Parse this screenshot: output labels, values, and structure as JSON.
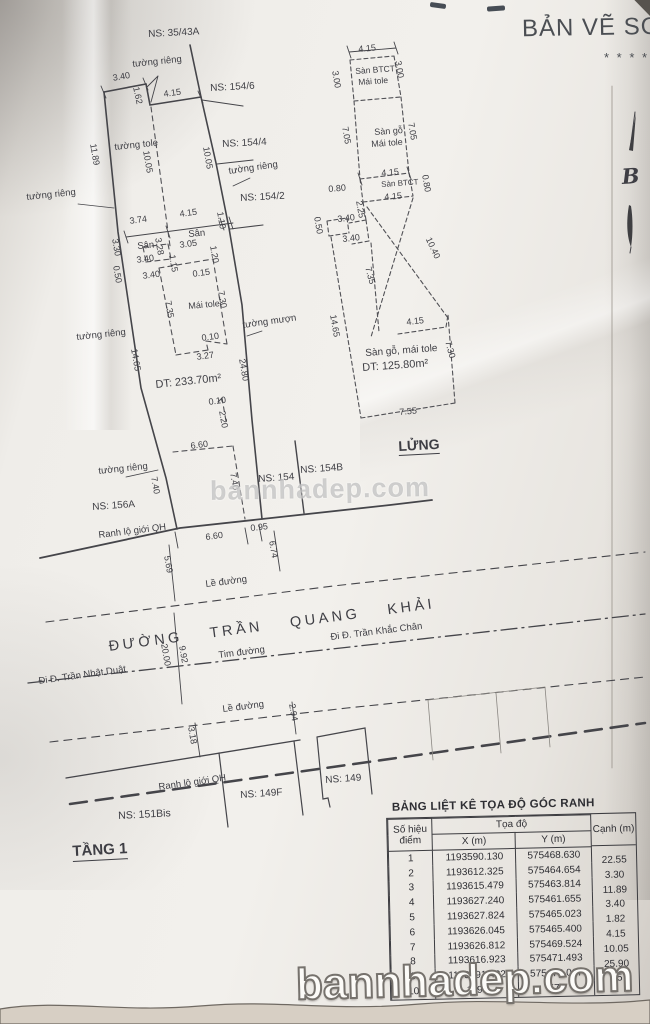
{
  "title": {
    "text": "BẢN VẼ SƠ",
    "stars": "* * * * *"
  },
  "watermark": {
    "middle": "bannhadep.com",
    "bottom": "bannhadep.com"
  },
  "table": {
    "title": "BẢNG LIỆT KÊ TỌA ĐỘ GÓC RANH",
    "headers": {
      "point": "Số hiệu điểm",
      "toado": "Tọa độ",
      "x": "X (m)",
      "y": "Y (m)",
      "canh": "Cạnh (m)"
    },
    "rows": [
      {
        "num": "1",
        "x": "1193590.130",
        "y": "575468.630"
      },
      {
        "num": "2",
        "x": "1193612.325",
        "y": "575464.654"
      },
      {
        "num": "3",
        "x": "1193615.479",
        "y": "575463.814"
      },
      {
        "num": "4",
        "x": "1193627.240",
        "y": "575461.655"
      },
      {
        "num": "5",
        "x": "1193627.824",
        "y": "575465.023"
      },
      {
        "num": "6",
        "x": "1193626.045",
        "y": "575465.400"
      },
      {
        "num": "7",
        "x": "1193626.812",
        "y": "575469.524"
      },
      {
        "num": "8",
        "x": "1193616.923",
        "y": "575471.493"
      },
      {
        "num": "9",
        "x": "1193591.432",
        "y": "575476.067"
      },
      {
        "num": "10",
        "x": "1193",
        "y": "575"
      }
    ],
    "canh_values": [
      "22.55",
      "3.30",
      "11.89",
      "3.40",
      "1.82",
      "4.15",
      "10.05",
      "25.90",
      "65"
    ]
  },
  "labels": [
    {
      "t": "NS: 35/43A",
      "x": 148,
      "y": 30,
      "r": -3,
      "s": 10,
      "n": "ns-label"
    },
    {
      "t": "tường riêng",
      "x": 132,
      "y": 60,
      "r": -6,
      "s": 9.5,
      "n": "wall-note"
    },
    {
      "t": "3.40",
      "x": 112,
      "y": 74,
      "r": -10,
      "s": 9
    },
    {
      "t": "1.62",
      "x": 140,
      "y": 86,
      "r": 78,
      "s": 9
    },
    {
      "t": "4.15",
      "x": 163,
      "y": 90,
      "r": -8,
      "s": 9
    },
    {
      "t": "NS: 154/6",
      "x": 210,
      "y": 84,
      "r": -3,
      "s": 10,
      "n": "ns-label"
    },
    {
      "t": "tường tole",
      "x": 114,
      "y": 143,
      "r": -6,
      "s": 9.5,
      "n": "wall-note"
    },
    {
      "t": "11.89",
      "x": 97,
      "y": 143,
      "r": 80,
      "s": 9
    },
    {
      "t": "10.05",
      "x": 150,
      "y": 150,
      "r": 80,
      "s": 9
    },
    {
      "t": "NS: 154/4",
      "x": 222,
      "y": 140,
      "r": -3,
      "s": 10,
      "n": "ns-label"
    },
    {
      "t": "10.05",
      "x": 210,
      "y": 146,
      "r": 80,
      "s": 9
    },
    {
      "t": "tường riêng",
      "x": 228,
      "y": 167,
      "r": -8,
      "s": 9.5,
      "n": "wall-note"
    },
    {
      "t": "tường riêng",
      "x": 26,
      "y": 193,
      "r": -6,
      "s": 9.5,
      "n": "wall-note"
    },
    {
      "t": "NS: 154/2",
      "x": 240,
      "y": 194,
      "r": -3,
      "s": 10,
      "n": "ns-label"
    },
    {
      "t": "3.74",
      "x": 129,
      "y": 217,
      "r": -8,
      "s": 9
    },
    {
      "t": "4.15",
      "x": 179,
      "y": 210,
      "r": -8,
      "s": 9
    },
    {
      "t": "1.10",
      "x": 224,
      "y": 211,
      "r": 80,
      "s": 9
    },
    {
      "t": "Sân",
      "x": 188,
      "y": 230,
      "r": -5,
      "s": 9.5,
      "n": "area-note"
    },
    {
      "t": "3.30",
      "x": 119,
      "y": 238,
      "r": 80,
      "s": 9
    },
    {
      "t": "Sân",
      "x": 137,
      "y": 242,
      "r": -5,
      "s": 9.5,
      "n": "area-note"
    },
    {
      "t": "3.28",
      "x": 162,
      "y": 237,
      "r": 80,
      "s": 9
    },
    {
      "t": "3.05",
      "x": 179,
      "y": 241,
      "r": -8,
      "s": 9
    },
    {
      "t": "1.20",
      "x": 217,
      "y": 245,
      "r": 80,
      "s": 9
    },
    {
      "t": "3.40",
      "x": 136,
      "y": 256,
      "r": -8,
      "s": 9
    },
    {
      "t": "1.15",
      "x": 176,
      "y": 254,
      "r": 80,
      "s": 9
    },
    {
      "t": "0.50",
      "x": 120,
      "y": 265,
      "r": 80,
      "s": 9
    },
    {
      "t": "3.40",
      "x": 142,
      "y": 272,
      "r": -8,
      "s": 9
    },
    {
      "t": "0.15",
      "x": 192,
      "y": 270,
      "r": -8,
      "s": 9
    },
    {
      "t": "7.35",
      "x": 172,
      "y": 300,
      "r": 80,
      "s": 9
    },
    {
      "t": "Mái tole",
      "x": 188,
      "y": 302,
      "r": -5,
      "s": 9,
      "n": "area-note"
    },
    {
      "t": "7.30",
      "x": 225,
      "y": 290,
      "r": 80,
      "s": 9
    },
    {
      "t": "tường mượn",
      "x": 242,
      "y": 321,
      "r": -8,
      "s": 9.5,
      "n": "wall-note"
    },
    {
      "t": "0.10",
      "x": 201,
      "y": 334,
      "r": -8,
      "s": 9
    },
    {
      "t": "3.27",
      "x": 196,
      "y": 353,
      "r": -8,
      "s": 9
    },
    {
      "t": "14.65",
      "x": 138,
      "y": 348,
      "r": 80,
      "s": 9
    },
    {
      "t": "24.80",
      "x": 246,
      "y": 358,
      "r": 80,
      "s": 9
    },
    {
      "t": "DT: 233.70m²",
      "x": 155,
      "y": 380,
      "r": -6,
      "s": 11,
      "n": "area-value"
    },
    {
      "t": "tường riêng",
      "x": 76,
      "y": 333,
      "r": -6,
      "s": 9.5,
      "n": "wall-note"
    },
    {
      "t": "0.10",
      "x": 208,
      "y": 398,
      "r": -8,
      "s": 9
    },
    {
      "t": "2.20",
      "x": 226,
      "y": 410,
      "r": 80,
      "s": 9
    },
    {
      "t": "6.60",
      "x": 190,
      "y": 442,
      "r": -8,
      "s": 9
    },
    {
      "t": "7.40",
      "x": 158,
      "y": 476,
      "r": 80,
      "s": 9
    },
    {
      "t": "7.40",
      "x": 237,
      "y": 472,
      "r": 80,
      "s": 9
    },
    {
      "t": "tường riêng",
      "x": 98,
      "y": 467,
      "r": -6,
      "s": 9.5,
      "n": "wall-note"
    },
    {
      "t": "NS: 156A",
      "x": 92,
      "y": 503,
      "r": -4,
      "s": 10,
      "n": "ns-label"
    },
    {
      "t": "NS: 154",
      "x": 258,
      "y": 475,
      "r": -4,
      "s": 10,
      "n": "ns-label"
    },
    {
      "t": "NS: 154B",
      "x": 300,
      "y": 466,
      "r": -4,
      "s": 10,
      "n": "ns-label"
    },
    {
      "t": "Ranh lộ giới QH",
      "x": 98,
      "y": 531,
      "r": -7,
      "s": 9.5,
      "n": "boundary-note"
    },
    {
      "t": "0.95",
      "x": 250,
      "y": 524,
      "r": -6,
      "s": 9
    },
    {
      "t": "6.60",
      "x": 205,
      "y": 533,
      "r": -7,
      "s": 9
    },
    {
      "t": "6.74",
      "x": 276,
      "y": 540,
      "r": 80,
      "s": 9
    },
    {
      "t": "5.69",
      "x": 171,
      "y": 555,
      "r": 80,
      "s": 9
    },
    {
      "t": "Lề đường",
      "x": 205,
      "y": 580,
      "r": -7,
      "s": 9.5,
      "n": "road-note"
    },
    {
      "t": "ĐƯỜNG TRẦN QUANG KHẢI",
      "x": 108,
      "y": 640,
      "r": -7.5,
      "s": 14.5,
      "ls": 3.5,
      "ws": 20,
      "n": "street-name"
    },
    {
      "t": "Tim đường",
      "x": 218,
      "y": 651,
      "r": -7,
      "s": 9.5,
      "n": "road-note"
    },
    {
      "t": "20.00",
      "x": 168,
      "y": 643,
      "r": 80,
      "s": 9
    },
    {
      "t": "9.92",
      "x": 186,
      "y": 645,
      "r": 80,
      "s": 9
    },
    {
      "t": "Đi Đ. Trần Nhật Duật",
      "x": 38,
      "y": 677,
      "r": -8,
      "s": 9.5,
      "n": "road-direction"
    },
    {
      "t": "Đi Đ. Trần Khắc Chân",
      "x": 330,
      "y": 633,
      "r": -7,
      "s": 9.5,
      "n": "road-direction"
    },
    {
      "t": "Lề đường",
      "x": 222,
      "y": 705,
      "r": -7,
      "s": 9.5,
      "n": "road-note"
    },
    {
      "t": "3.18",
      "x": 195,
      "y": 726,
      "r": 80,
      "s": 9
    },
    {
      "t": "2.94",
      "x": 296,
      "y": 703,
      "r": 80,
      "s": 9
    },
    {
      "t": "Ranh lộ giới QH",
      "x": 158,
      "y": 783,
      "r": -8,
      "s": 9.5,
      "n": "boundary-note"
    },
    {
      "t": "NS: 149F",
      "x": 240,
      "y": 791,
      "r": -4,
      "s": 10,
      "n": "ns-label"
    },
    {
      "t": "NS: 149",
      "x": 325,
      "y": 776,
      "r": -4,
      "s": 10,
      "n": "ns-label"
    },
    {
      "t": "NS: 151Bis",
      "x": 118,
      "y": 811,
      "r": -3,
      "s": 10.5,
      "n": "ns-label"
    },
    {
      "t": "TẦNG 1",
      "x": 72,
      "y": 844,
      "r": -3,
      "s": 15,
      "b": 1,
      "u": 1,
      "n": "floor-title"
    },
    {
      "t": "4.15",
      "x": 358,
      "y": 45,
      "r": -5,
      "s": 9
    },
    {
      "t": "3.00",
      "x": 339,
      "y": 70,
      "r": 80,
      "s": 9
    },
    {
      "t": "Sàn BTCT",
      "x": 355,
      "y": 67,
      "r": -4,
      "s": 8.5,
      "n": "area-note"
    },
    {
      "t": "Mái tole",
      "x": 358,
      "y": 78,
      "r": -4,
      "s": 8.5,
      "n": "area-note"
    },
    {
      "t": "3.00",
      "x": 402,
      "y": 60,
      "r": 80,
      "s": 9
    },
    {
      "t": "7.05",
      "x": 349,
      "y": 126,
      "r": 80,
      "s": 9
    },
    {
      "t": "Sàn gỗ",
      "x": 374,
      "y": 128,
      "r": -4,
      "s": 9,
      "n": "area-note"
    },
    {
      "t": "Mái tole",
      "x": 371,
      "y": 140,
      "r": -4,
      "s": 9,
      "n": "area-note"
    },
    {
      "t": "7.05",
      "x": 415,
      "y": 122,
      "r": 80,
      "s": 9
    },
    {
      "t": "4.15",
      "x": 381,
      "y": 169,
      "r": -5,
      "s": 9
    },
    {
      "t": "0.80",
      "x": 328,
      "y": 185,
      "r": -5,
      "s": 9
    },
    {
      "t": "Sàn BTCT",
      "x": 381,
      "y": 181,
      "r": -4,
      "s": 8,
      "n": "area-note"
    },
    {
      "t": "0.80",
      "x": 429,
      "y": 174,
      "r": 80,
      "s": 9
    },
    {
      "t": "4.15",
      "x": 384,
      "y": 193,
      "r": -5,
      "s": 9
    },
    {
      "t": "2.25",
      "x": 363,
      "y": 200,
      "r": 80,
      "s": 9
    },
    {
      "t": "3.40",
      "x": 337,
      "y": 215,
      "r": -6,
      "s": 9
    },
    {
      "t": "0.50",
      "x": 321,
      "y": 216,
      "r": 80,
      "s": 9
    },
    {
      "t": "3.40",
      "x": 342,
      "y": 235,
      "r": -6,
      "s": 9
    },
    {
      "t": "10.40",
      "x": 432,
      "y": 236,
      "r": 65,
      "s": 9
    },
    {
      "t": "7.35",
      "x": 372,
      "y": 266,
      "r": 75,
      "s": 9
    },
    {
      "t": "14.65",
      "x": 337,
      "y": 314,
      "r": 80,
      "s": 9
    },
    {
      "t": "4.15",
      "x": 406,
      "y": 318,
      "r": -6,
      "s": 9
    },
    {
      "t": "7.30",
      "x": 452,
      "y": 340,
      "r": 75,
      "s": 9
    },
    {
      "t": "Sàn gỗ, mái tole",
      "x": 365,
      "y": 349,
      "r": -4,
      "s": 10,
      "n": "area-note"
    },
    {
      "t": "DT: 125.80m²",
      "x": 362,
      "y": 363,
      "r": -4,
      "s": 11,
      "n": "area-value"
    },
    {
      "t": "7.55",
      "x": 399,
      "y": 408,
      "r": -5,
      "s": 9
    },
    {
      "t": "LỬNG",
      "x": 398,
      "y": 439,
      "r": -3,
      "s": 14,
      "b": 1,
      "u": 1,
      "n": "floor-title"
    },
    {
      "t": "B",
      "x": 621,
      "y": 166,
      "r": -4,
      "s": 21,
      "f": 1,
      "n": "north-arrow-letter"
    }
  ]
}
